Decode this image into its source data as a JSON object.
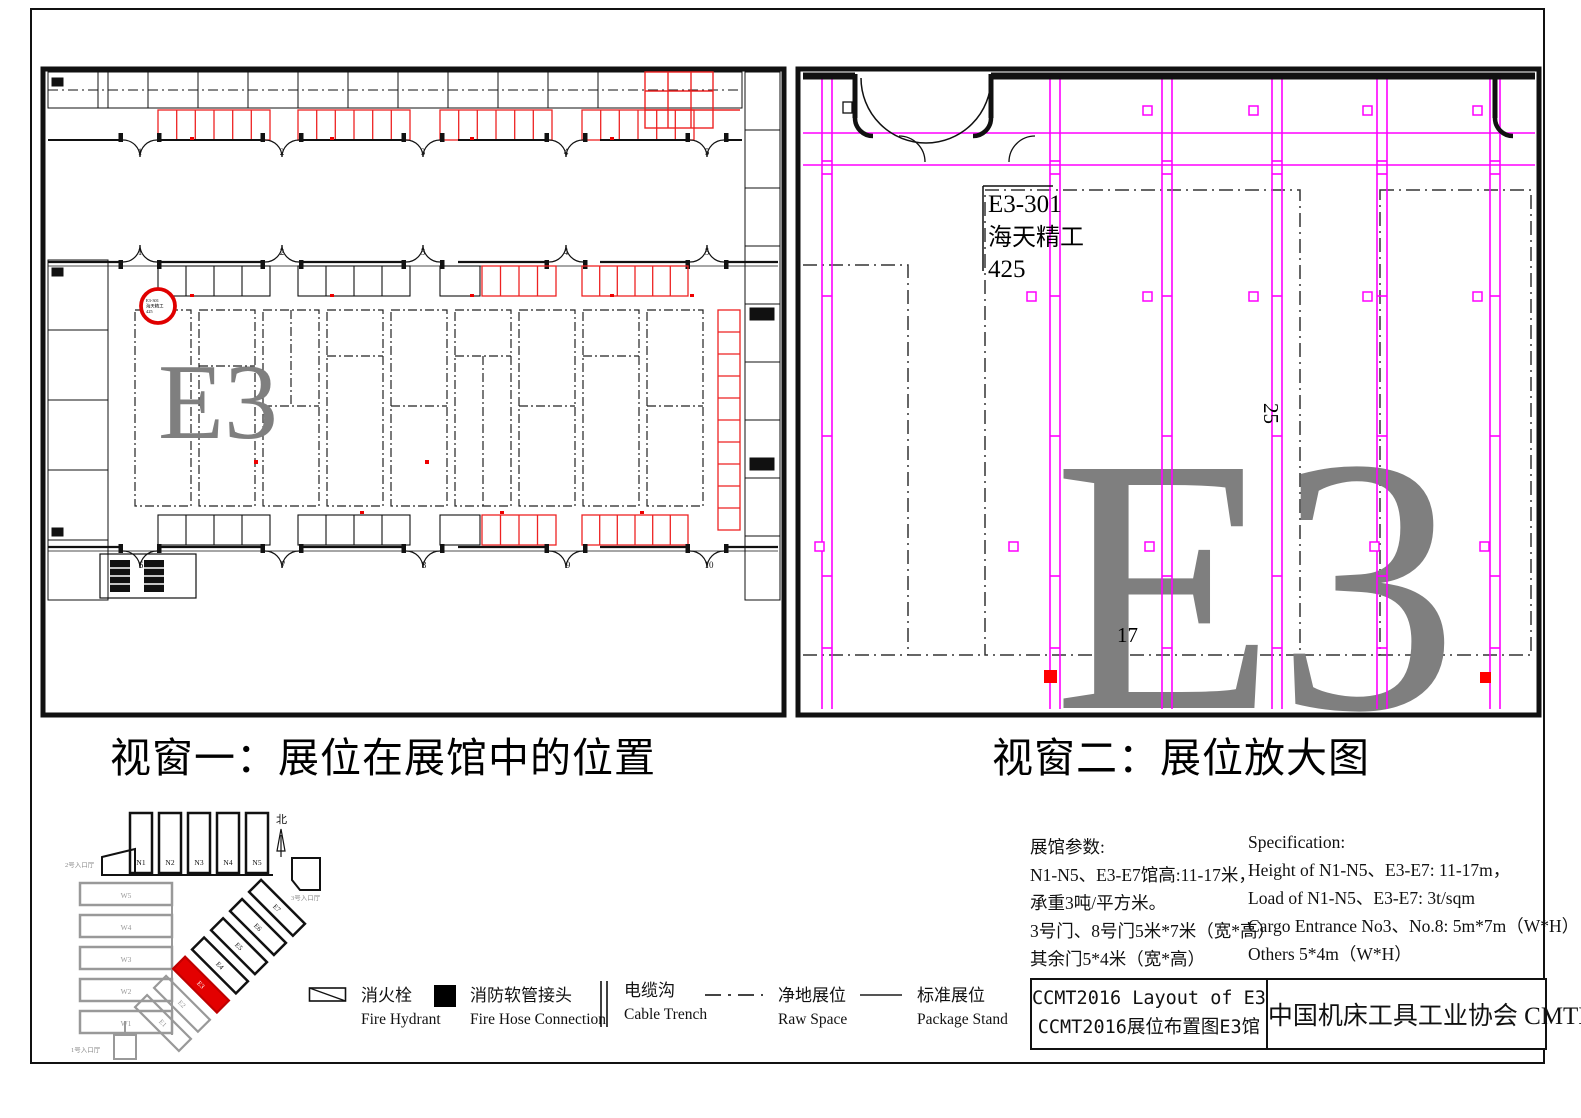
{
  "sheet": {
    "window1_caption": "视窗一：展位在展馆中的位置",
    "window2_caption": "视窗二：展位放大图"
  },
  "overview": {
    "watermark": "E3",
    "gates_top": [
      "1",
      "2",
      "3",
      "4",
      "5"
    ],
    "gates_mid": [
      "1",
      "2",
      "3",
      "4",
      "5"
    ],
    "gates_bottom": [
      "6",
      "7",
      "8",
      "9",
      "10"
    ],
    "marker": {
      "line1": "E3-301",
      "line2": "海天精工",
      "line3": "425"
    }
  },
  "detail": {
    "watermark": "E3",
    "booth": {
      "id": "E3-301",
      "name": "海天精工",
      "area": "425"
    },
    "dims": {
      "depth": "25",
      "width": "17"
    }
  },
  "minimap": {
    "north": "北",
    "n_halls": [
      "N1",
      "N2",
      "N3",
      "N4",
      "N5"
    ],
    "w_halls": [
      "W5",
      "W4",
      "W3",
      "W2",
      "W1"
    ],
    "e_halls": [
      "E1",
      "E2",
      "E3",
      "E4",
      "E5",
      "E6",
      "E7"
    ],
    "highlighted_hall": "E3",
    "entrance_top": "2号入口厅",
    "entrance_right": "3号入口厅",
    "entrance_bottom": "1号入口厅"
  },
  "legend": {
    "items": [
      {
        "cn": "消火栓",
        "en": "Fire Hydrant",
        "symbol": "fire-hydrant"
      },
      {
        "cn": "消防软管接头",
        "en": "Fire Hose Connection",
        "symbol": "fire-hose-connection"
      },
      {
        "cn": "电缆沟",
        "en": "Cable Trench",
        "symbol": "cable-trench"
      },
      {
        "cn": "净地展位",
        "en": "Raw Space",
        "symbol": "raw-space"
      },
      {
        "cn": "标准展位",
        "en": "Package Stand",
        "symbol": "package-stand"
      }
    ]
  },
  "specs": {
    "cn_title": "展馆参数:",
    "cn_lines": [
      "N1-N5、E3-E7馆高:11-17米，",
      "承重3吨/平方米。",
      "3号门、8号门5米*7米（宽*高）",
      "其余门5*4米（宽*高）"
    ],
    "en_title": "Specification:",
    "en_lines": [
      "Height of N1-N5、E3-E7: 11-17m，",
      "Load of N1-N5、E3-E7: 3t/sqm",
      "Cargo Entrance No3、No.8: 5m*7m（W*H）",
      "Others 5*4m（W*H）"
    ]
  },
  "title_block": {
    "title_en": "CCMT2016  Layout  of  E3",
    "title_cn": "CCMT2016展位布置图E3馆",
    "org": "中国机床工具工业协会  CMTBA"
  },
  "colors": {
    "accent_magenta": "#FF00FF",
    "accent_red": "#EE1111",
    "watermark_gray": "#7F7F7F"
  }
}
